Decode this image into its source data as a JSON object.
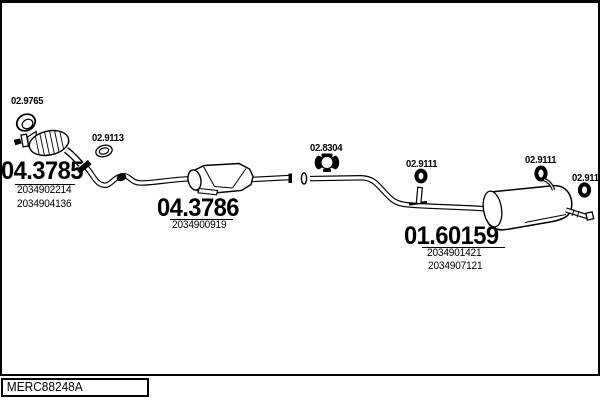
{
  "parts": {
    "front_catalyst": {
      "number": "04.3785",
      "oe_numbers": [
        "2034902214",
        "2034904136"
      ]
    },
    "centre_catalyst": {
      "number": "04.3786",
      "oe_numbers": [
        "2034900919"
      ]
    },
    "rear_silencer": {
      "number": "01.60159",
      "oe_numbers": [
        "2034901421",
        "2034907121"
      ]
    }
  },
  "fittings": {
    "gasket": "02.9765",
    "seal_ring": "02.9113",
    "clamp": "02.8304",
    "hangers": [
      "02.9111",
      "02.9111",
      "02.9111"
    ]
  },
  "footer": {
    "code": "MERC88248A"
  },
  "colors": {
    "line": "#000000",
    "background": "#ffffff"
  }
}
